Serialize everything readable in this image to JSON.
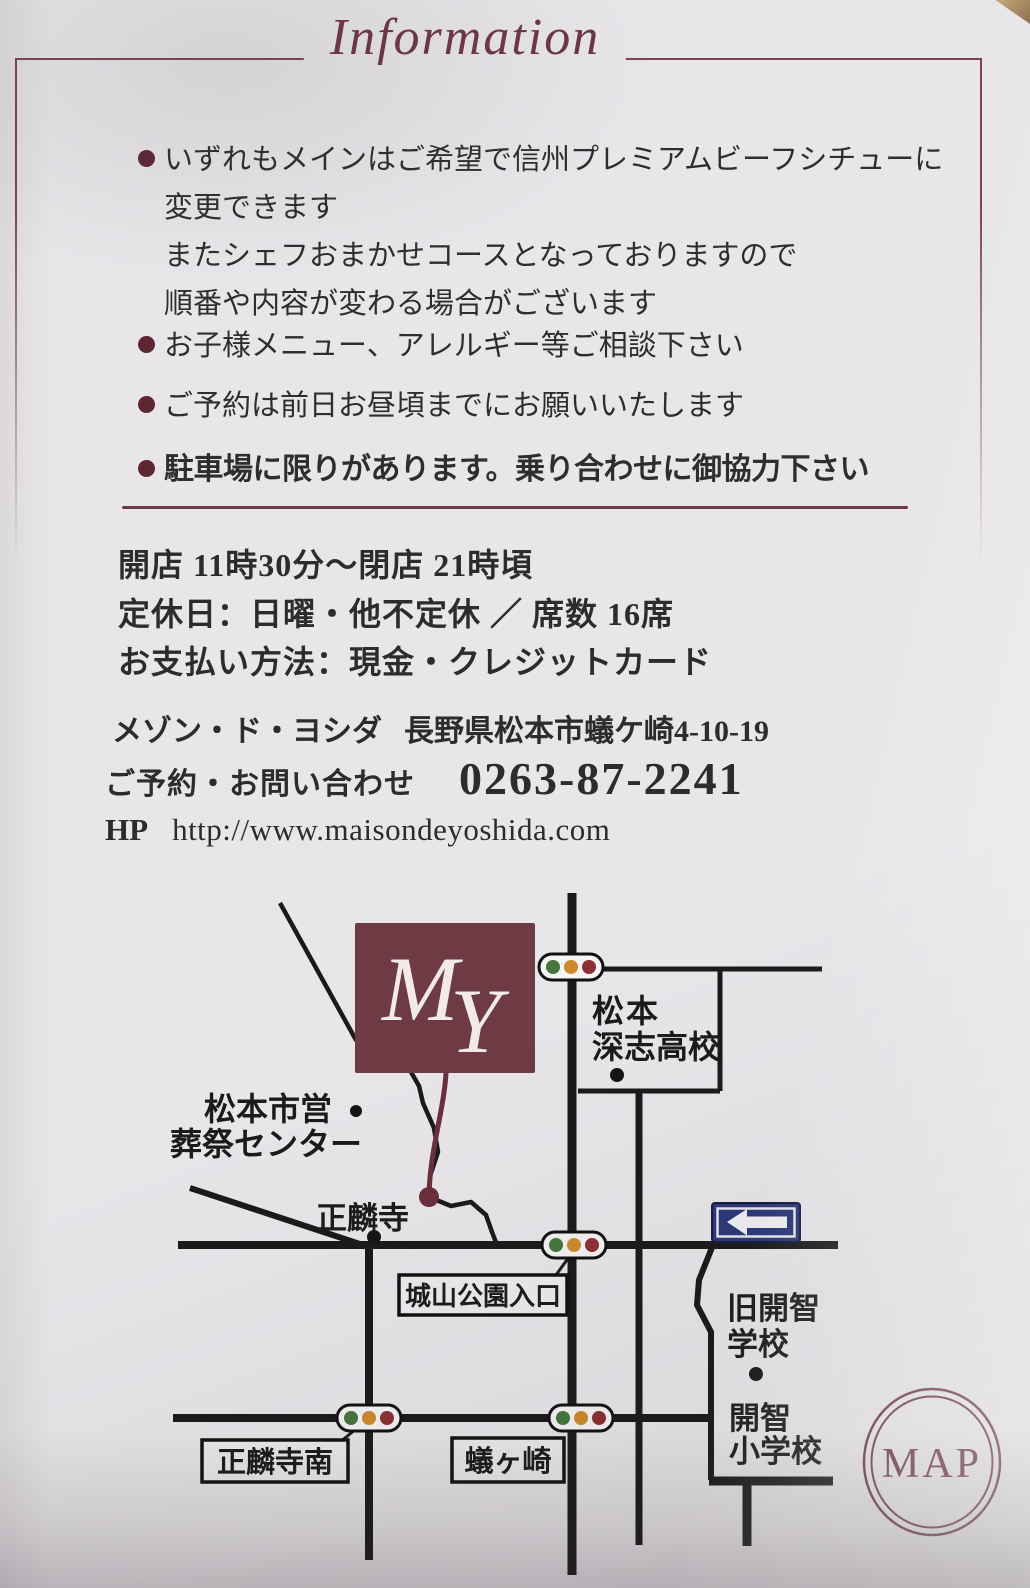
{
  "header": {
    "title": "Information"
  },
  "notes": [
    {
      "lines": [
        "いずれもメインはご希望で信州プレミアムビーフシチューに",
        "変更できます",
        "またシェフおまかせコースとなっておりますので",
        "順番や内容が変わる場合がございます"
      ]
    },
    {
      "lines": [
        "お子様メニュー、アレルギー等ご相談下さい"
      ]
    },
    {
      "lines": [
        "ご予約は前日お昼頃までにお願いいたします"
      ]
    },
    {
      "lines": [
        "駐車場に限りがあります。乗り合わせに御協力下さい"
      ]
    }
  ],
  "details": {
    "hours": "開店 11時30分～閉店 21時頃",
    "closed": "定休日：日曜・他不定休 ／ 席数 16席",
    "payment": "お支払い方法：現金・クレジットカード"
  },
  "contact": {
    "name": "メゾン・ド・ヨシダ",
    "address": "長野県松本市蟻ケ崎4-10-19",
    "reserve_label": "ご予約・お問い合わせ",
    "phone": "0263-87-2241",
    "hp_label": "HP",
    "url": "http://www.maisondeyoshida.com"
  },
  "map": {
    "monogram": {
      "m": "M",
      "y": "Y"
    },
    "badge": "MAP",
    "labels": {
      "fukashi_1": "松本",
      "fukashi_2": "深志高校",
      "sousai_1": "松本市営",
      "sousai_2": "葬祭センター",
      "shorinji": "正麟寺",
      "shiroyama": "城山公園入口",
      "shorinji_minami": "正麟寺南",
      "arigasaki": "蟻ヶ崎",
      "kyukaichi_1": "旧開智",
      "kyukaichi_2": "学校",
      "kaichi_1": "開智",
      "kaichi_2": "小学校"
    },
    "colors": {
      "maroon": "#6e3a44",
      "road": "#1a1a1a",
      "sign_navy": "#2c3878",
      "signal_green": "#45763c",
      "signal_amber": "#cd8a2a",
      "signal_red": "#8d2f36"
    }
  }
}
